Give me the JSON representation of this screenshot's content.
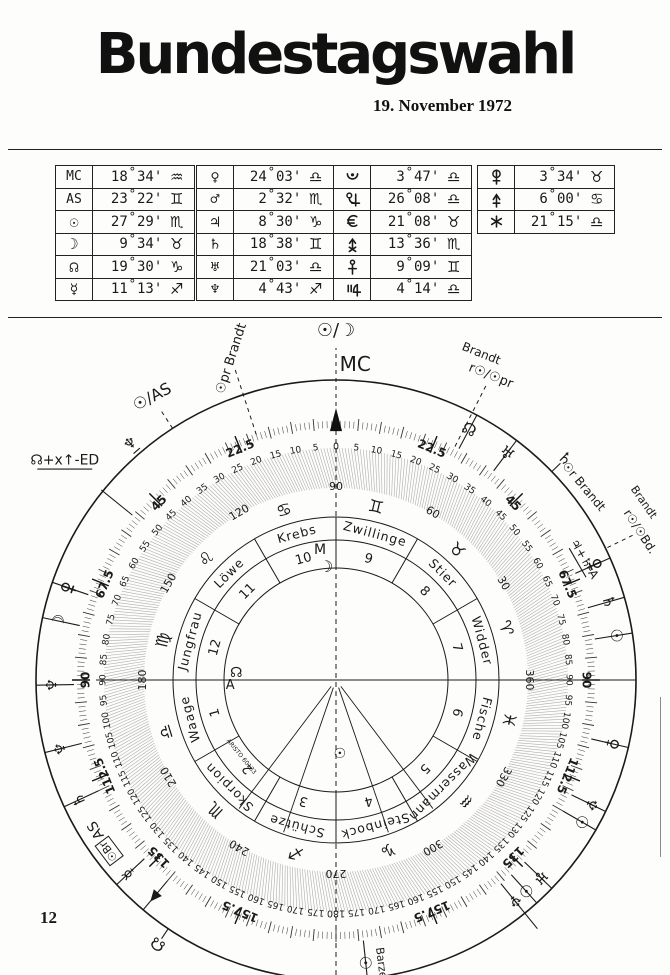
{
  "page": {
    "title": "Bundestagswahl",
    "date": "19. November 1972",
    "page_number": "12"
  },
  "glyph_chars": {
    "sun": "☉",
    "moon": "☽",
    "mercury": "☿",
    "venus": "♀",
    "mars": "♂",
    "jupiter": "♃",
    "saturn": "♄",
    "uranus": "♅",
    "neptune": "♆",
    "pluto": "♇",
    "node": "☊",
    "aries": "♈",
    "taurus": "♉",
    "gemini": "♊",
    "cancer": "♋",
    "leo": "♌",
    "virgo": "♍",
    "libra": "♎",
    "scorpio": "♏",
    "sagittarius": "♐",
    "capricorn": "♑",
    "aquarius": "♒",
    "pisces": "♓"
  },
  "position_tables": [
    {
      "name": "angles-and-lights",
      "x": 55,
      "y": 165,
      "w": 138,
      "rows": [
        {
          "body": "mc",
          "label": "MC",
          "deg": "18",
          "min": "34",
          "sign": "aquarius"
        },
        {
          "body": "as",
          "label": "AS",
          "deg": "23",
          "min": "22",
          "sign": "gemini"
        },
        {
          "body": "sun",
          "deg": "27",
          "min": "29",
          "sign": "scorpio"
        },
        {
          "body": "moon",
          "deg": "9",
          "min": "34",
          "sign": "taurus"
        },
        {
          "body": "node",
          "deg": "19",
          "min": "30",
          "sign": "capricorn"
        },
        {
          "body": "mercury",
          "deg": "11",
          "min": "13",
          "sign": "sagittarius"
        }
      ]
    },
    {
      "name": "classical-planets",
      "x": 196,
      "y": 165,
      "w": 136,
      "rows": [
        {
          "body": "venus",
          "deg": "24",
          "min": "03",
          "sign": "libra"
        },
        {
          "body": "mars",
          "deg": "2",
          "min": "32",
          "sign": "scorpio"
        },
        {
          "body": "jupiter",
          "deg": "8",
          "min": "30",
          "sign": "capricorn"
        },
        {
          "body": "saturn",
          "deg": "18",
          "min": "38",
          "sign": "gemini"
        },
        {
          "body": "uranus",
          "deg": "21",
          "min": "03",
          "sign": "libra"
        },
        {
          "body": "neptune",
          "deg": "4",
          "min": "43",
          "sign": "sagittarius"
        }
      ]
    },
    {
      "name": "pluto-and-transneptunians",
      "x": 333,
      "y": 165,
      "w": 137,
      "rows": [
        {
          "body": "pluto_crescent",
          "deg": "3",
          "min": "47",
          "sign": "libra"
        },
        {
          "body": "cupido",
          "deg": "26",
          "min": "08",
          "sign": "libra"
        },
        {
          "body": "hades",
          "deg": "21",
          "min": "08",
          "sign": "taurus"
        },
        {
          "body": "zeus",
          "deg": "13",
          "min": "36",
          "sign": "scorpio"
        },
        {
          "body": "kronos",
          "deg": "9",
          "min": "09",
          "sign": "gemini"
        },
        {
          "body": "apollon",
          "deg": "4",
          "min": "14",
          "sign": "libra"
        }
      ]
    },
    {
      "name": "transneptunians-2",
      "x": 477,
      "y": 165,
      "w": 136,
      "rows": [
        {
          "body": "admetos",
          "deg": "3",
          "min": "34",
          "sign": "taurus"
        },
        {
          "body": "vulkanus",
          "deg": "6",
          "min": "00",
          "sign": "cancer"
        },
        {
          "body": "poseidon",
          "deg": "21",
          "min": "15",
          "sign": "libra"
        }
      ]
    }
  ],
  "wheel": {
    "brand_text": "ARISTO 60133",
    "center": {
      "x": 336,
      "y": 680
    },
    "outer_scale": {
      "max": 180,
      "label_step": 5,
      "specials": [
        22.5,
        45,
        67.5,
        90,
        112.5,
        135,
        157.5
      ]
    },
    "ring360_labels": [
      [
        0,
        "90"
      ],
      [
        30,
        "60"
      ],
      [
        60,
        "30"
      ],
      [
        90,
        "360"
      ],
      [
        120,
        "330"
      ],
      [
        150,
        "300"
      ],
      [
        180,
        "270"
      ],
      [
        210,
        "240"
      ],
      [
        240,
        "210"
      ],
      [
        270,
        "180"
      ],
      [
        300,
        "150"
      ],
      [
        330,
        "120"
      ]
    ],
    "signs": [
      {
        "name": "Zwillinge",
        "glyph": "gemini",
        "house": "9",
        "a": 15
      },
      {
        "name": "Stier",
        "glyph": "taurus",
        "house": "8",
        "a": 45
      },
      {
        "name": "Widder",
        "glyph": "aries",
        "house": "7",
        "a": 75
      },
      {
        "name": "Fische",
        "glyph": "pisces",
        "house": "6",
        "a": 105
      },
      {
        "name": "Wassermann",
        "glyph": "aquarius",
        "house": "5",
        "a": 135
      },
      {
        "name": "Steinbock",
        "glyph": "capricorn",
        "house": "4",
        "a": 165
      },
      {
        "name": "Schütze",
        "glyph": "sagittarius",
        "house": "3",
        "a": 195
      },
      {
        "name": "Skorpion",
        "glyph": "scorpio",
        "house": "2",
        "a": 225
      },
      {
        "name": "Waage",
        "glyph": "libra",
        "house": "1",
        "a": 255
      },
      {
        "name": "Jungfrau",
        "glyph": "virgo",
        "house": "12",
        "a": 285
      },
      {
        "name": "Löwe",
        "glyph": "leo",
        "house": "11",
        "a": 315
      },
      {
        "name": "Krebs",
        "glyph": "cancer",
        "house": "10",
        "a": 345
      }
    ],
    "rim_markers": [
      {
        "a": 28,
        "glyph": "node"
      },
      {
        "a": 37,
        "glyph": "uranus"
      },
      {
        "a": 46,
        "glyph": "saturn",
        "zone": "out"
      },
      {
        "a": 66,
        "glyph": "admetos"
      },
      {
        "a": 74,
        "glyph": "saturn"
      },
      {
        "a": 81,
        "glyph": "sun"
      },
      {
        "a": 103,
        "glyph": "venus"
      },
      {
        "a": 116,
        "glyph": "neptune"
      },
      {
        "a": 120,
        "glyph": "sun"
      },
      {
        "a": 134,
        "glyph": "uranus"
      },
      {
        "a": 138,
        "glyph": "sun"
      },
      {
        "a": 141,
        "glyph": "neptune",
        "cross_rim": true
      },
      {
        "a": 174,
        "glyph": "sun"
      },
      {
        "a": -71,
        "glyph": "admetos"
      },
      {
        "a": -78,
        "glyph": "moon"
      },
      {
        "a": -91,
        "glyph": "neptune"
      },
      {
        "a": -104,
        "glyph": "neptune"
      },
      {
        "a": -115,
        "glyph": "saturn"
      },
      {
        "a": -133,
        "glyph": "mercury"
      },
      {
        "a": -140,
        "glyph": "triangle"
      },
      {
        "a": -146,
        "glyph": "node",
        "zone": "out"
      }
    ],
    "annotations": [
      {
        "name": "sun-moon-midpoint",
        "text": "☉/☽",
        "a": 0,
        "r": 349,
        "rot": 0,
        "fs": 18,
        "tick": "dashed",
        "t1": 258,
        "t2": 332
      },
      {
        "name": "mc-label",
        "text": "MC",
        "a": 3.5,
        "r": 315,
        "rot": 0,
        "fs": 20
      },
      {
        "name": "sun-progressed-brandt",
        "text": "☉pr Brandt",
        "a": -18,
        "r": 338,
        "rot": -72,
        "fs": 13,
        "tick": "dashed",
        "t1": 258,
        "t2": 330
      },
      {
        "name": "sun-as-midpoint",
        "text": "☉/AS",
        "a": -33,
        "r": 337,
        "rot": -28,
        "fs": 16,
        "tick": "dashed",
        "t1": 300,
        "t2": 322
      },
      {
        "name": "neptune-outside",
        "text": "♆",
        "a": -41,
        "r": 313,
        "rot": -41,
        "fs": 15,
        "underline": true
      },
      {
        "name": "node-zeus-ed",
        "text": "☊+x↑-ED",
        "a": -51,
        "r": 349,
        "rot": 0,
        "fs": 14,
        "underline": true,
        "tick": "solid",
        "t1": 262,
        "t2": 302
      },
      {
        "name": "brandt-radix-prog-1",
        "text": "Brandt",
        "a": 24,
        "r": 357,
        "rot": 22,
        "fs": 12
      },
      {
        "name": "brandt-radix-prog-2",
        "text": "r☉/☉pr",
        "a": 27,
        "r": 341,
        "rot": 22,
        "fs": 13,
        "tick": "dashed",
        "t1": 262,
        "t2": 330
      },
      {
        "name": "sun-radix-brandt",
        "text": "☉r Brandt",
        "a": 52,
        "r": 314,
        "rot": 50,
        "fs": 12
      },
      {
        "name": "jupiter-saturn-as",
        "text": "♃+♄-A",
        "a": 64,
        "r": 276,
        "rot": 60,
        "fs": 12,
        "underline": true
      },
      {
        "name": "brandt-rsun-bd-1",
        "text": "Brandt",
        "a": 60,
        "r": 355,
        "rot": 55,
        "fs": 11
      },
      {
        "name": "brandt-rsun-bd-2",
        "text": "r☉/☉Bd.",
        "a": 64,
        "r": 338,
        "rot": 57,
        "fs": 12,
        "tick": "dashed",
        "t1": 302,
        "t2": 330
      },
      {
        "name": "barzel-label",
        "text": "Barzel",
        "a": 171,
        "r": 288,
        "rot": 83,
        "fs": 11
      },
      {
        "name": "as-marker",
        "text": "AS",
        "a": -122,
        "r": 283,
        "rot": -122,
        "fs": 14
      },
      {
        "name": "sun-barzel-boxed",
        "text": "☉Br",
        "a": -127,
        "r": 284,
        "rot": -127,
        "fs": 11,
        "boxed": true
      }
    ],
    "center_marks": [
      {
        "name": "moon-at-mc-m",
        "text": "M",
        "a": -7,
        "r": 131,
        "fs": 14
      },
      {
        "name": "moon-at-mc-glyph",
        "text": "☽",
        "a": -5,
        "r": 113,
        "fs": 16
      },
      {
        "name": "asc-mark-a",
        "text": "A",
        "a": -93,
        "r": 106,
        "fs": 13
      },
      {
        "name": "asc-mark-node",
        "text": "☊",
        "a": -86,
        "r": 100,
        "fs": 14
      },
      {
        "name": "sun-center-mark",
        "text": "☉",
        "a": 177,
        "r": 74,
        "fs": 14
      },
      {
        "name": "aristo-brand",
        "text": "ARISTO 60133",
        "a": -129,
        "r": 122,
        "fs": 6,
        "tangent_flip": true,
        "gray": true
      }
    ],
    "aspect_arm_angles": [
      143,
      161,
      199,
      217
    ]
  }
}
